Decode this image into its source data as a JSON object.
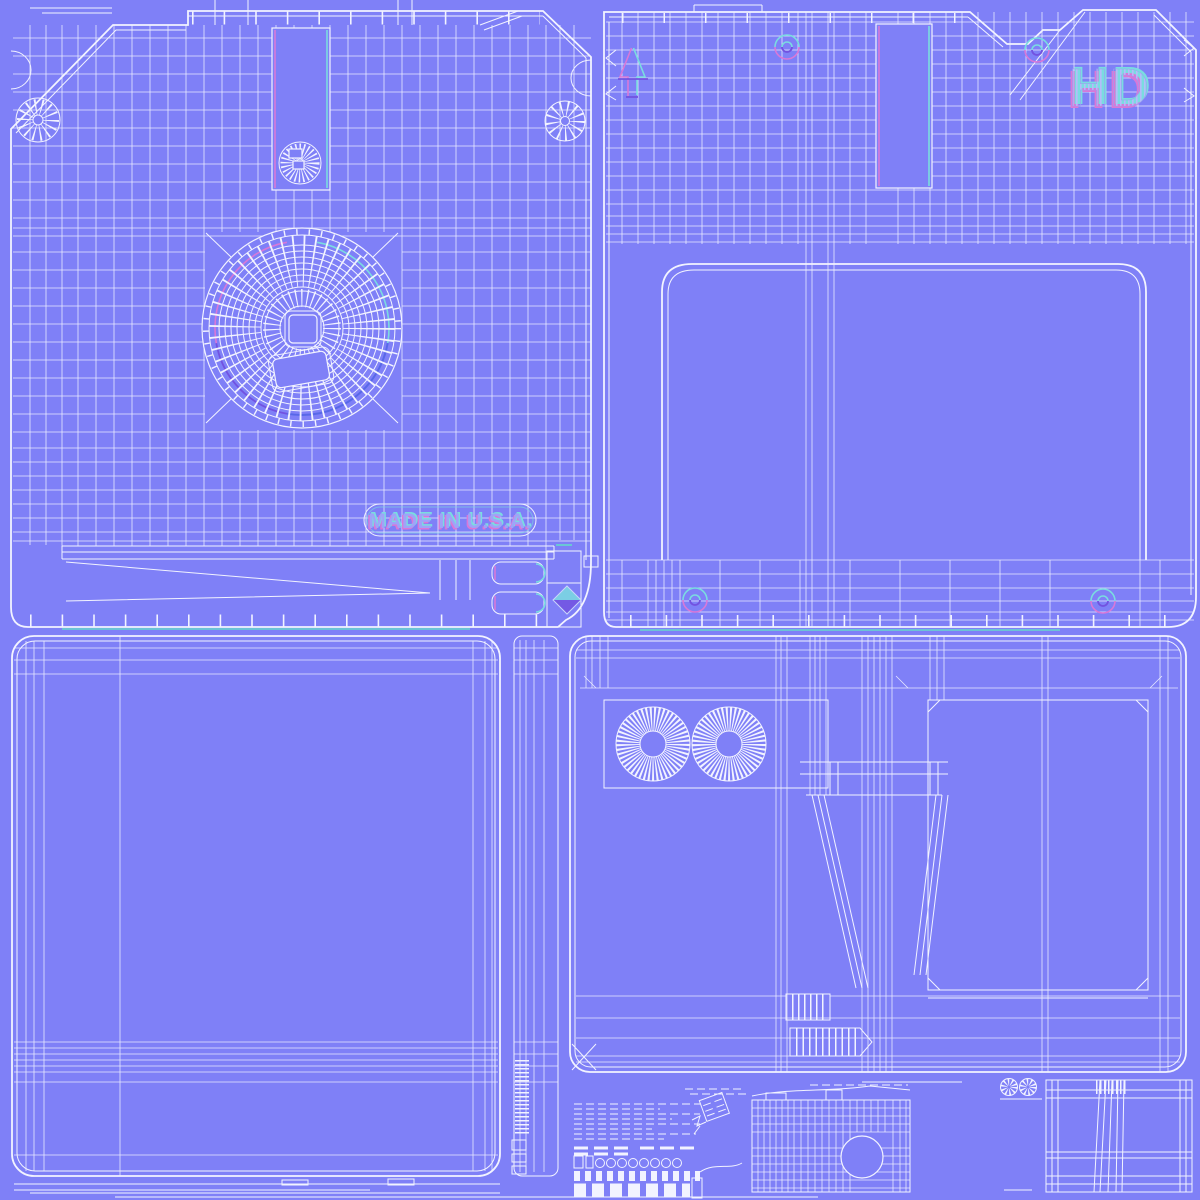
{
  "texts": {
    "made_in_usa": "MADE IN U.S.A.",
    "hd_logo": "HD"
  },
  "colors": {
    "bg": "#7f80f7",
    "wire": "#f2f3ff",
    "pink": "#d878d8",
    "cyan": "#7adce0",
    "purple": "#7252e0",
    "blue": "#5868e8",
    "teal": "#66d8cc",
    "lav": "#9fa3f8"
  }
}
